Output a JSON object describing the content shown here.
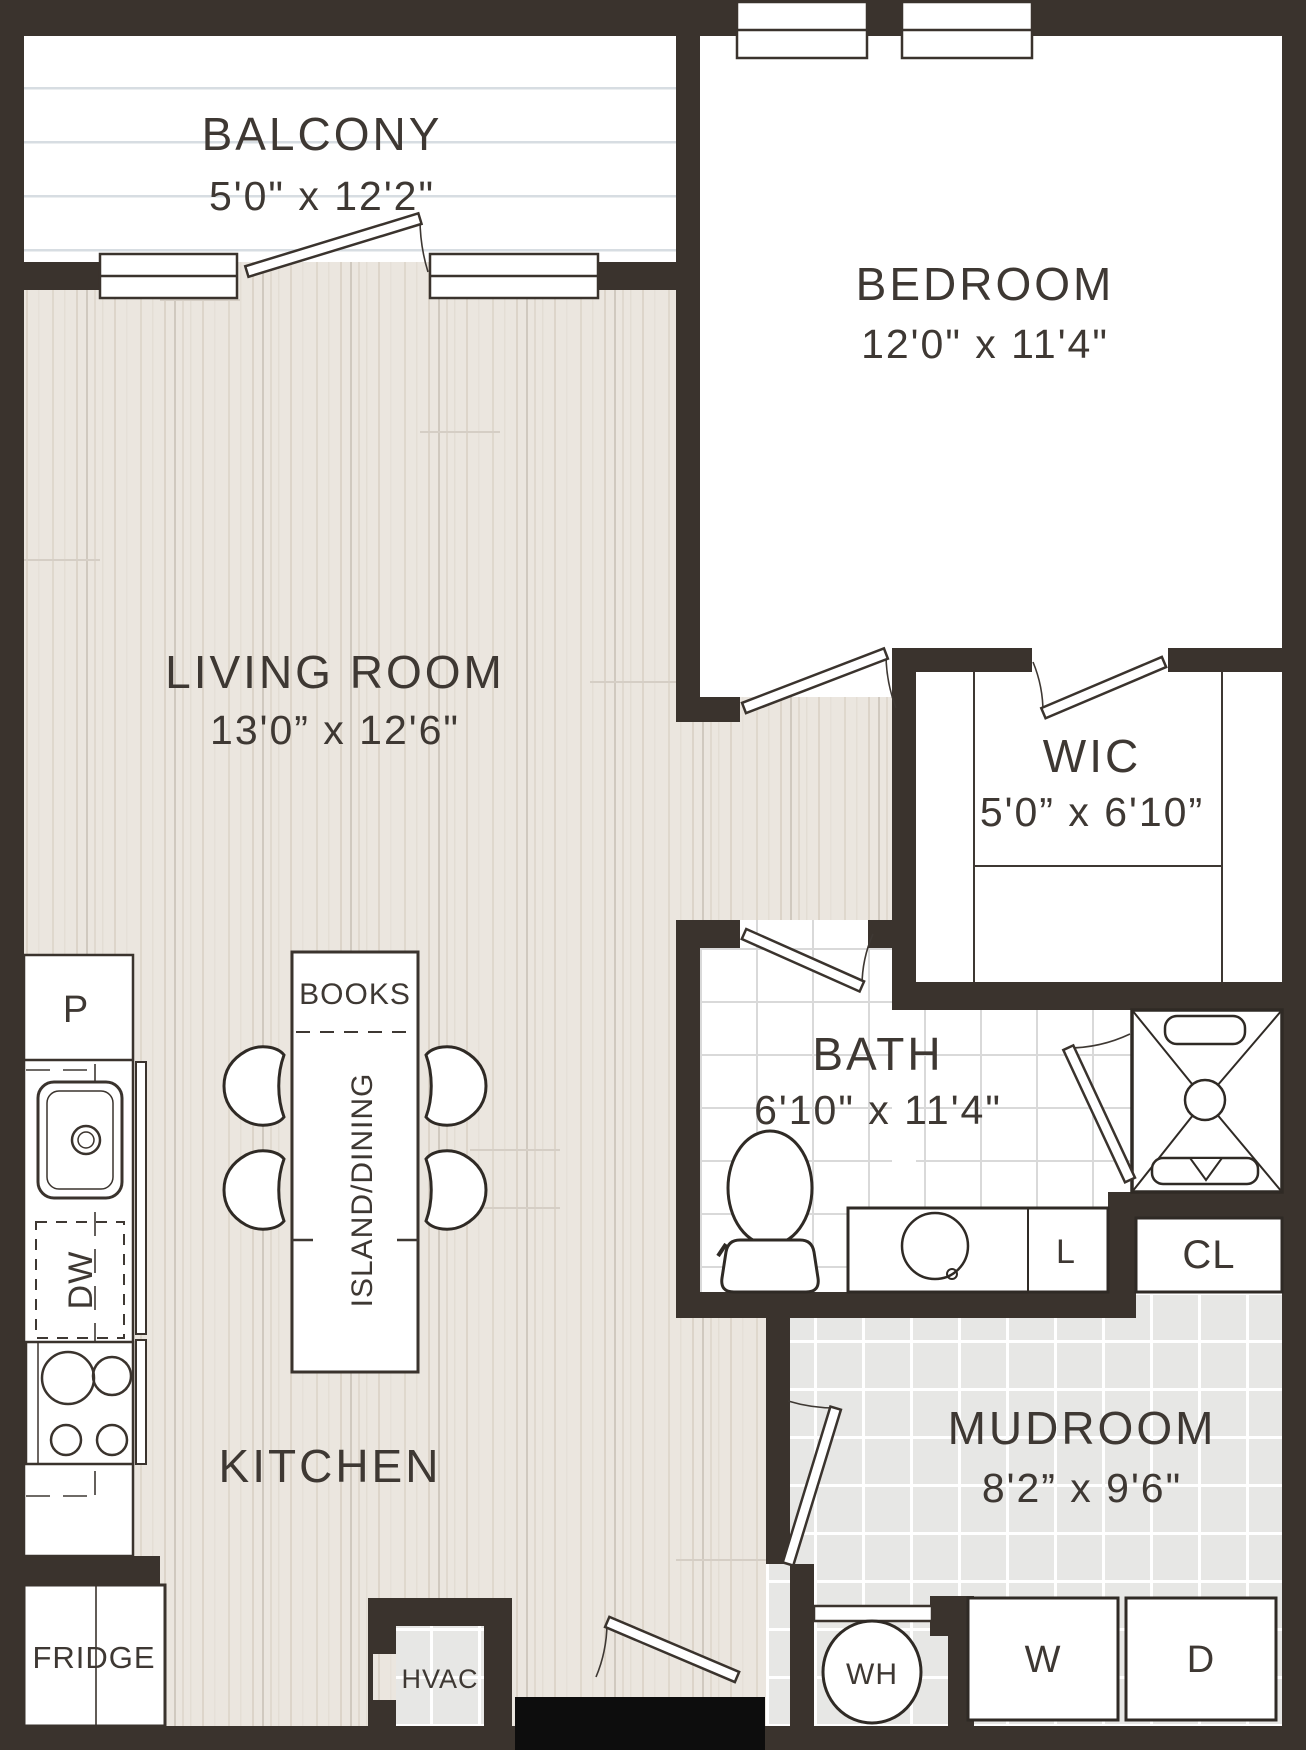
{
  "plan": {
    "rooms": {
      "balcony": {
        "label": "BALCONY",
        "dims": "5'0\" x 12'2\""
      },
      "bedroom": {
        "label": "BEDROOM",
        "dims": "12'0\" x 11'4\""
      },
      "living_room": {
        "label": "LIVING ROOM",
        "dims": "13'0” x 12'6\""
      },
      "wic": {
        "label": "WIC",
        "dims": "5'0” x 6'10”"
      },
      "bath": {
        "label": "BATH",
        "dims": "6'10\" x 11'4\""
      },
      "mudroom": {
        "label": "MUDROOM",
        "dims": "8'2” x 9'6\""
      },
      "kitchen": {
        "label": "KITCHEN"
      }
    },
    "fixtures": {
      "pantry": "P",
      "dishwasher": "DW",
      "fridge": "FRIDGE",
      "hvac": "HVAC",
      "books": "BOOKS",
      "island_dining": "ISLAND/DINING",
      "linen": "L",
      "closet": "CL",
      "water_heater": "WH",
      "washer": "W",
      "dryer": "D"
    },
    "colors": {
      "wall": "#3a332d",
      "entry_threshold": "#0d0d0d",
      "wood_floor": "#ebe6df",
      "gray_tile": "#e7e7e5",
      "line": "#3e3833"
    }
  }
}
